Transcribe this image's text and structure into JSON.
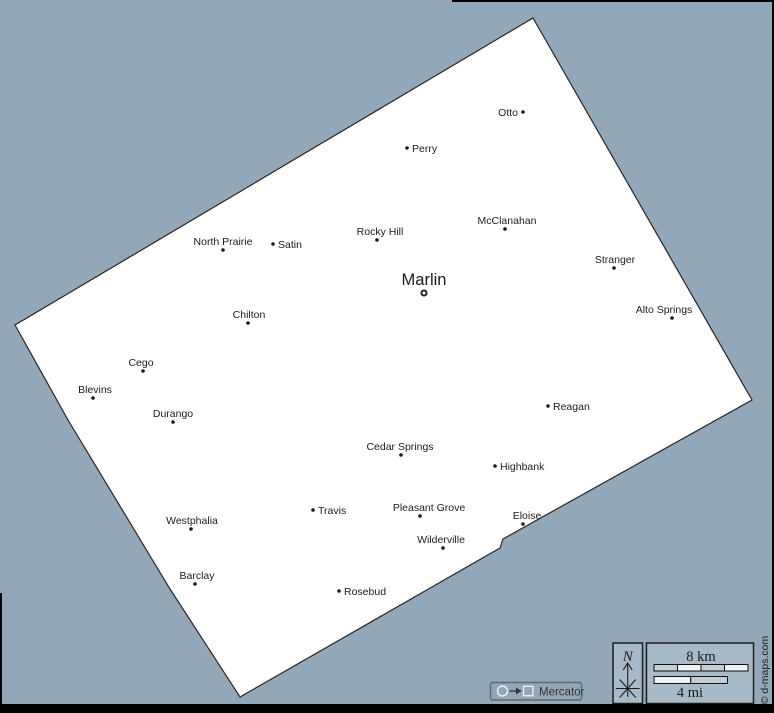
{
  "colors": {
    "background": "#92a8b9",
    "county_fill": "#ffffff",
    "county_stroke": "#252525",
    "label": "#1c1c1c",
    "frame": "#000000",
    "legend_box_fill": "#a6bbc7",
    "legend_box_stroke": "#1e1e1e",
    "scale_gray": "#c4ced5",
    "scale_white": "#eef1f3",
    "scale_stroke": "#111111",
    "badge_stroke": "#5d6b75",
    "badge_symbol": "#edf0f2",
    "badge_text": "#333333",
    "attribution_text": "#1a1a1a"
  },
  "map": {
    "polygon_points": "533,18 752,400 503,539 500,548 240,697 170,589 68,420 15,325",
    "county_seat": {
      "name": "Marlin",
      "x": 424,
      "y": 293,
      "label_x": 424,
      "label_y": 285
    },
    "cities": [
      {
        "name": "Otto",
        "x": 523,
        "y": 112,
        "anchor": "left"
      },
      {
        "name": "Perry",
        "x": 407,
        "y": 148,
        "anchor": "right"
      },
      {
        "name": "McClanahan",
        "x": 505,
        "y": 229,
        "anchor": "above",
        "lx": 507
      },
      {
        "name": "Rocky Hill",
        "x": 377,
        "y": 240,
        "anchor": "above",
        "lx": 380
      },
      {
        "name": "North Prairie",
        "x": 223,
        "y": 250,
        "anchor": "above"
      },
      {
        "name": "Satin",
        "x": 273,
        "y": 244,
        "anchor": "right"
      },
      {
        "name": "Stranger",
        "x": 614,
        "y": 268,
        "anchor": "above",
        "lx": 615
      },
      {
        "name": "Alto Springs",
        "x": 672,
        "y": 318,
        "anchor": "above",
        "lx": 664
      },
      {
        "name": "Chilton",
        "x": 248,
        "y": 323,
        "anchor": "above",
        "lx": 249
      },
      {
        "name": "Cego",
        "x": 143,
        "y": 371,
        "anchor": "above",
        "lx": 141
      },
      {
        "name": "Blevins",
        "x": 93,
        "y": 398,
        "anchor": "above",
        "lx": 95
      },
      {
        "name": "Reagan",
        "x": 548,
        "y": 406,
        "anchor": "right"
      },
      {
        "name": "Durango",
        "x": 173,
        "y": 422,
        "anchor": "above"
      },
      {
        "name": "Cedar Springs",
        "x": 401,
        "y": 455,
        "anchor": "above",
        "lx": 400
      },
      {
        "name": "Highbank",
        "x": 495,
        "y": 466,
        "anchor": "right"
      },
      {
        "name": "Travis",
        "x": 313,
        "y": 510,
        "anchor": "right"
      },
      {
        "name": "Pleasant Grove",
        "x": 420,
        "y": 516,
        "anchor": "above",
        "lx": 429
      },
      {
        "name": "Eloise",
        "x": 523,
        "y": 524,
        "anchor": "above",
        "lx": 527
      },
      {
        "name": "Westphalia",
        "x": 191,
        "y": 529,
        "anchor": "above",
        "lx": 192
      },
      {
        "name": "Wilderville",
        "x": 443,
        "y": 548,
        "anchor": "above",
        "lx": 441
      },
      {
        "name": "Barclay",
        "x": 195,
        "y": 584,
        "anchor": "above",
        "lx": 197
      },
      {
        "name": "Rosebud",
        "x": 339,
        "y": 591,
        "anchor": "right"
      }
    ]
  },
  "legend": {
    "compass": {
      "north_label": "N"
    },
    "scale": {
      "km_label": "8 km",
      "mi_label": "4 mi"
    }
  },
  "projection_badge": {
    "label": "Mercator"
  },
  "attribution": "© d-maps.com"
}
